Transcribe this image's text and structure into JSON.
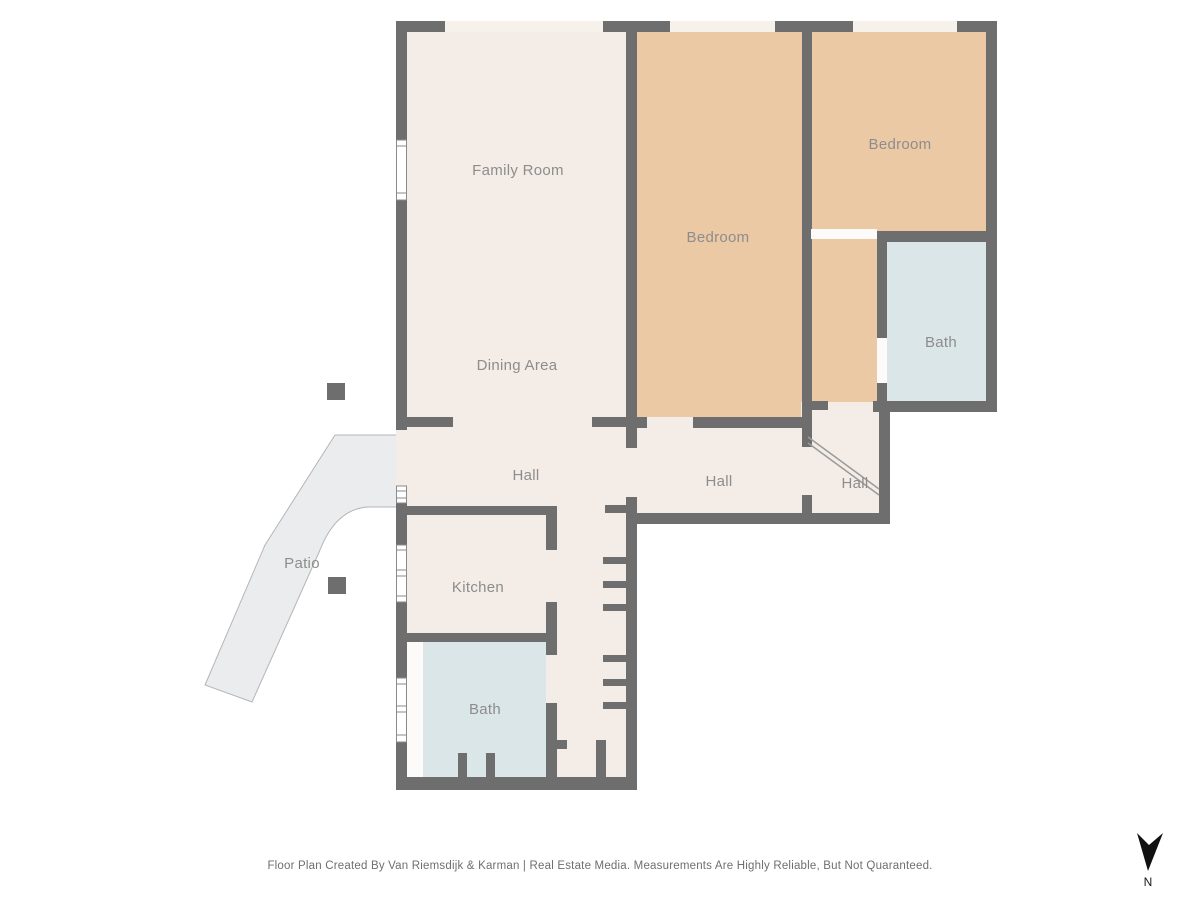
{
  "colors": {
    "wall": "#6e6e6e",
    "room": "#f4ece6",
    "bedroom": "#ecc9a5",
    "bath": "#dbe6e8",
    "patio": "#ebecee",
    "patio_border": "#b5b5b8",
    "window_gap": "#f7f1eb",
    "label": "#8d8d8d"
  },
  "rooms": {
    "family_room": "Family Room",
    "dining_area": "Dining Area",
    "bedroom_center": "Bedroom",
    "bedroom_right": "Bedroom",
    "bath_right": "Bath",
    "hall_main": "Hall",
    "hall_center": "Hall",
    "hall_right": "Hall",
    "kitchen": "Kitchen",
    "bath_lower": "Bath",
    "patio": "Patio"
  },
  "compass": {
    "label": "N"
  },
  "footer": {
    "text": "Floor Plan Created By Van Riemsdijk & Karman | Real Estate Media. Measurements Are Highly Reliable, But Not Quaranteed."
  }
}
